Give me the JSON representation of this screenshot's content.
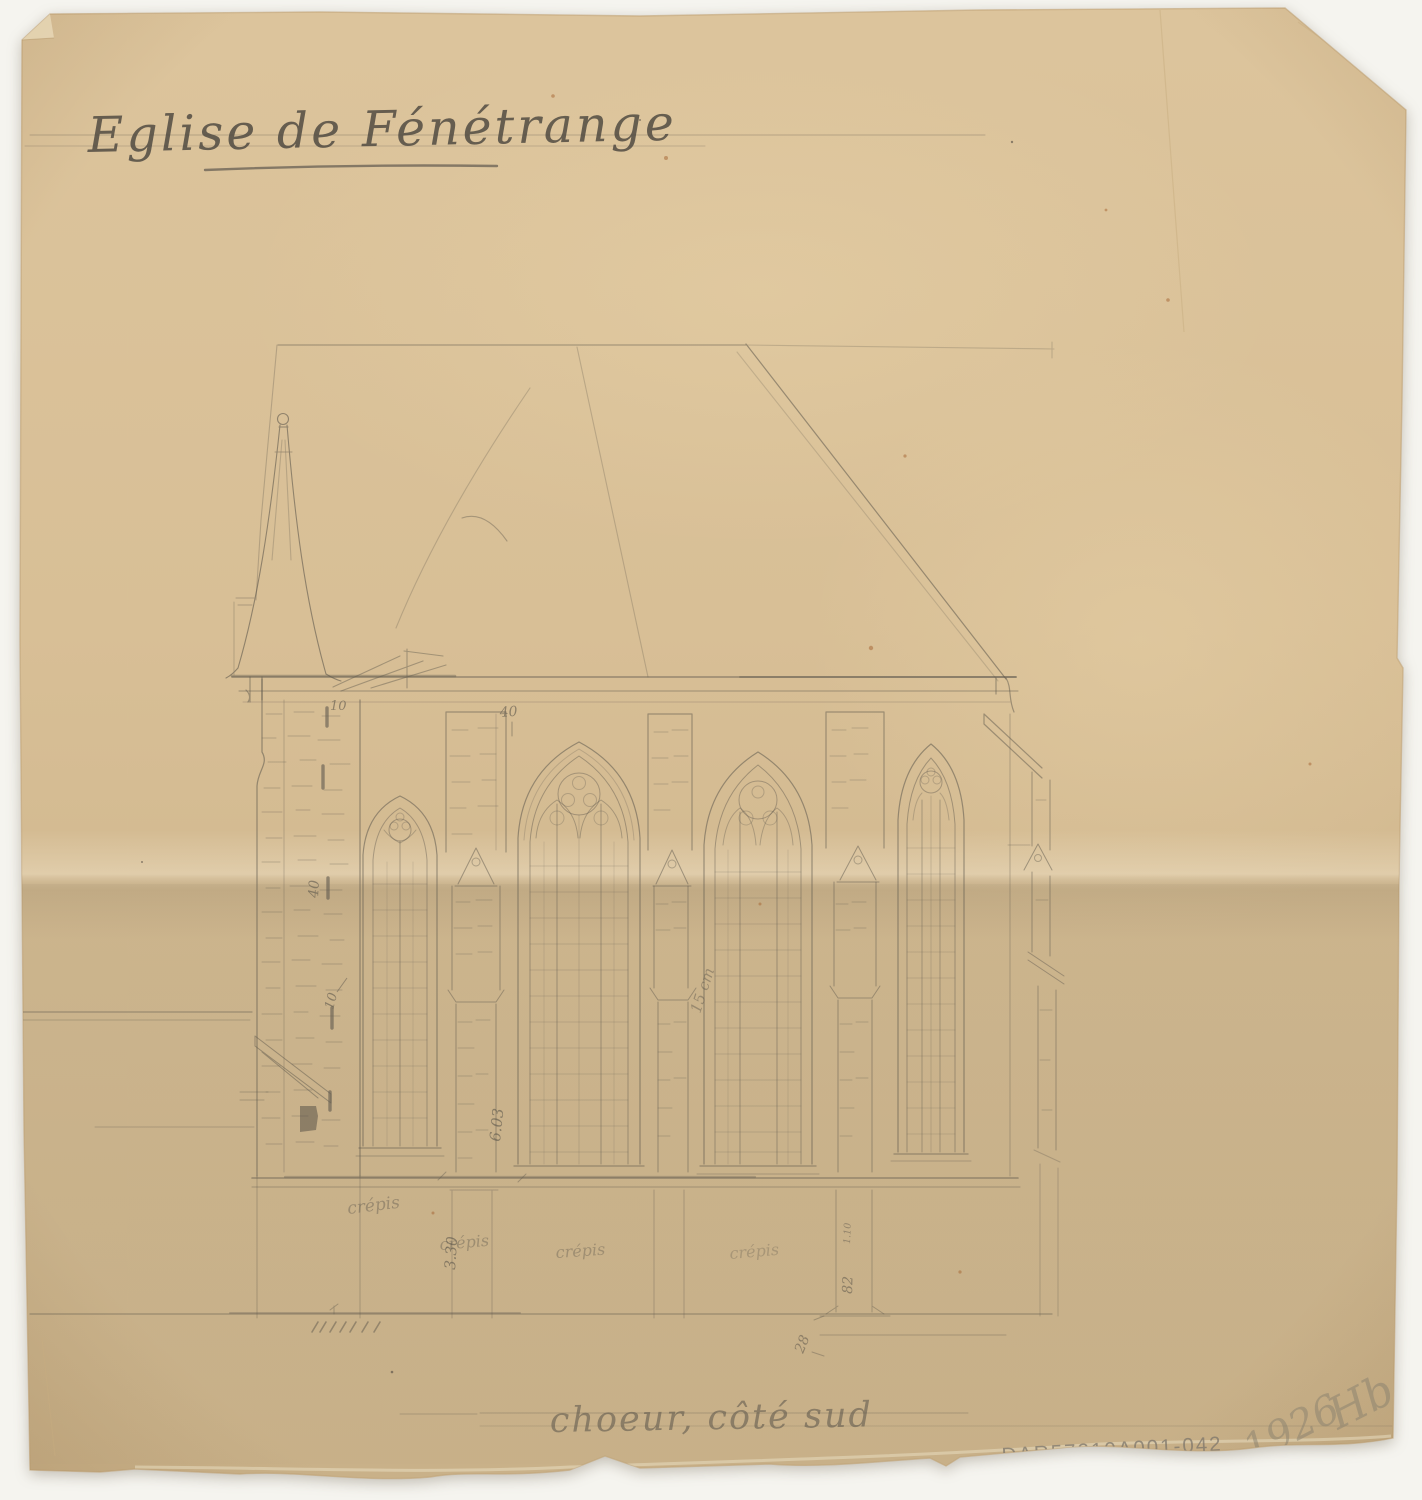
{
  "document": {
    "title": "Eglise de Fénétrange",
    "caption": "choeur, côté sud",
    "reference_number": "DAR57210A001-042",
    "date_mark": "1926",
    "monogram": "Hb",
    "subject": "church elevation pencil drawing"
  },
  "annotations": {
    "eaves_10": "10",
    "eaves_40": "40",
    "tower_40": "40",
    "tower_10": "10",
    "buttress_603": "6.03",
    "base_330": "3.30",
    "wall_15cm": "15 cm",
    "buttress_110": "1.10",
    "buttress_82": "82",
    "base_28": "28",
    "crepis_a": "crépis",
    "crepis_b": "crépis",
    "crepis_c": "crépis",
    "crepis_d": "crépis"
  },
  "colors": {
    "background": "#f5f4ef",
    "paper_top": "#dcc49c",
    "paper_mid": "#d6bd94",
    "paper_bottom": "#c9b189",
    "paper_edge": "#c2a377",
    "pencil": "#5f594e",
    "handwriting": "#4c473f",
    "foxing": "#a4622f"
  }
}
